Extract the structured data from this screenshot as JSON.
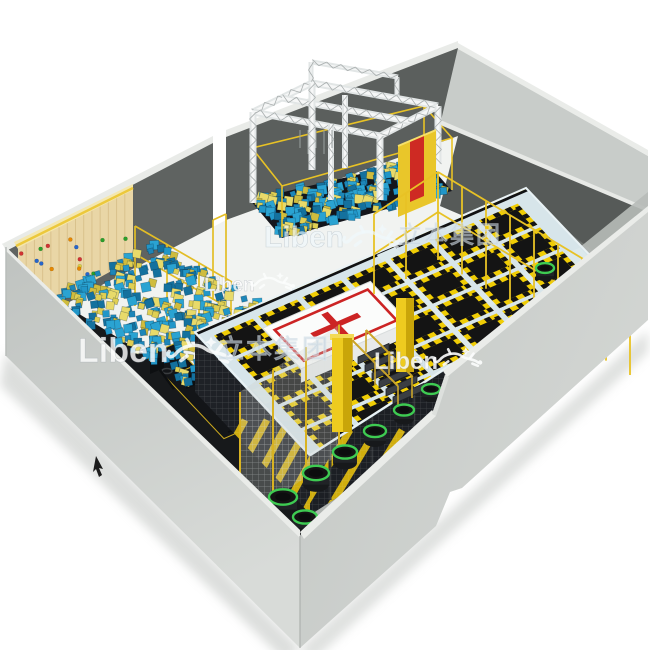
{
  "image": {
    "kind": "3d-render",
    "subject": "indoor trampoline park perspective floor-plan render",
    "background": "#ffffff",
    "width": 650,
    "height": 650
  },
  "branding": {
    "logo_text": "Liben",
    "logo_cn": "立本集团"
  },
  "watermarks": [
    {
      "id": "wm-top",
      "text": "Liben",
      "gecko": true,
      "cn": false
    },
    {
      "id": "wm-left",
      "text": "Liben",
      "gecko": true,
      "cn": true
    },
    {
      "id": "wm-center",
      "text": "Liben",
      "gecko": true,
      "cn": true
    },
    {
      "id": "wm-bottom",
      "text": "Liben",
      "gecko": true,
      "cn": false
    }
  ],
  "palette": {
    "wall_outer": "#c8ccc9",
    "wall_outer_light": "#d8dbd8",
    "wall_top": "#eaece9",
    "wall_dark": "#5c605e",
    "floor": "#f1f3f1",
    "carpet": "#6f7370",
    "wood": "#e9d6a6",
    "wood_line": "#d9c28c",
    "wood_trim": "#f4e7ae",
    "foam_blue": [
      "#1d86b8",
      "#2196c8",
      "#14719e",
      "#2aa3d2"
    ],
    "foam_yellow": [
      "#e0cf52",
      "#cfbc3e",
      "#e8da6a"
    ],
    "pit_dark": "#14161c",
    "deck": "#d7e5ea",
    "mat_black": "#141414",
    "pad_yellow": "#f0cd05",
    "fence_yellow": "#e8c225",
    "truss_silver": "#e2e6e6",
    "truss_shade": "#a9aeae",
    "red": "#cc2424",
    "pad_white": "#fbfcfb",
    "green_rim": "#3ecb52",
    "column_yellow": "#e3bd12",
    "mesh_dark": "#1c1f24",
    "watermark": "rgba(252,253,253,0.82)",
    "watermark_cn": "rgba(175,196,214,0.55)",
    "hold_colors": [
      "#d23333",
      "#2aa02a",
      "#2666cc",
      "#e88800",
      "#ddd044"
    ]
  },
  "scene": {
    "areas": [
      "ball-pit-with-climbing-wall",
      "ninja-truss-over-foam-pit",
      "main-trampoline-court",
      "airbag-target-pad",
      "dunk-lanes",
      "caged-corner",
      "mini-round-trampolines",
      "stairs-to-platform"
    ],
    "foam_cubes_ball_pit": 380,
    "foam_cubes_truss_pit": 230,
    "climbing_holds": 18,
    "court_grid": {
      "cols": 7,
      "rows": 5
    },
    "basketball_hoops": 3,
    "stair_steps": 6,
    "green_trampolines": [
      [
        283,
        497,
        14
      ],
      [
        316,
        473,
        13
      ],
      [
        345,
        452,
        12
      ],
      [
        375,
        431,
        11
      ],
      [
        404,
        410,
        10
      ],
      [
        431,
        389,
        9
      ],
      [
        545,
        268,
        9
      ],
      [
        305,
        517,
        12
      ]
    ]
  }
}
